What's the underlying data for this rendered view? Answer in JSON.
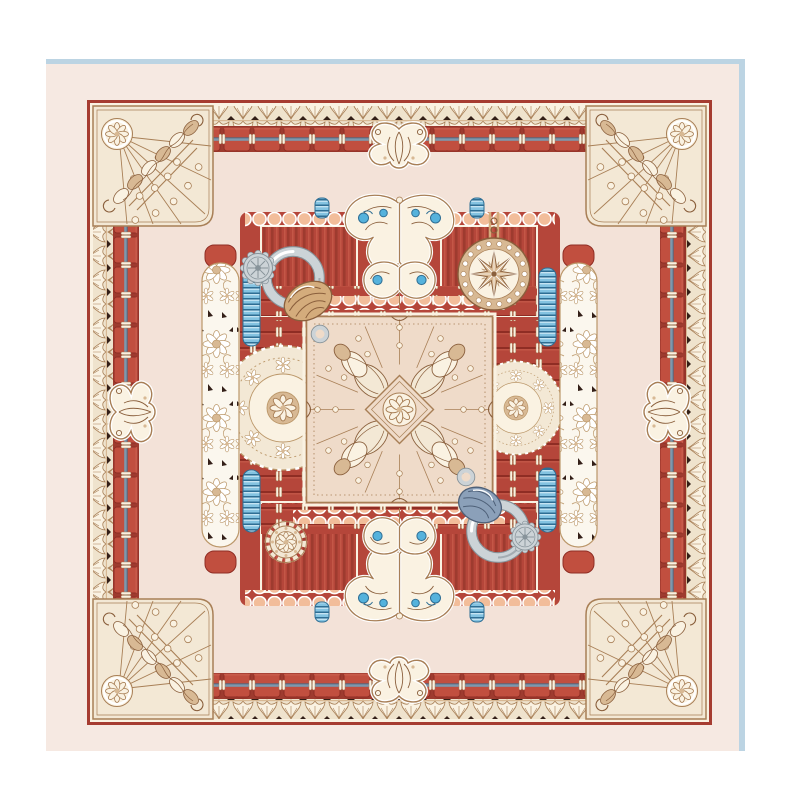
{
  "page": {
    "background": "#ffffff",
    "type": "product-photo-page"
  },
  "photo": {
    "subject": "square silk twill scarf, flat lay",
    "background": "#f6e9e2",
    "frame_line_color": "#bcd4e3",
    "frame_lines": [
      "top",
      "right"
    ]
  },
  "palette": {
    "pure": "#ffffff",
    "photoBg": "#f6e9e2",
    "frameBlue": "#bcd4e3",
    "field": "#f3e2d8",
    "redLine": "#a63c31",
    "red": "#b5463a",
    "redDark": "#8f2d24",
    "tabRed": "#c14f3f",
    "tabHi": "#c85b4a",
    "gapRed": "#9e3b2f",
    "bandBlue": "#7d98ad",
    "cream": "#f3e8d5",
    "creamHi": "#faf2e2",
    "tan": "#d8b994",
    "tanLine": "#a87f56",
    "tanDark": "#8a5f3c",
    "darkAccent": "#331f18",
    "squareBg": "#efdbc9",
    "peach": "#f2bd9a",
    "blue": "#84c3e1",
    "blueDark": "#2e6e94",
    "blueLight": "#cfeaf6",
    "accentBlue": "#55b2dc",
    "silver": "#ccd3d7",
    "silverDark": "#87939a",
    "ropeTan": "#d4ac7c",
    "ropeBlue": "#8ba0b9",
    "ropeBlueDark": "#4e6078",
    "laceBg": "#fbf7ee",
    "laceLine": "#bb9769",
    "garlandBg": "#efe3cd"
  },
  "scarf": {
    "shape": "square",
    "border": {
      "outer_pinstripe": "dark red line with cream inner pinstripe",
      "garland_band": "cream acanthus-leaf garland with dark notches",
      "stitched_band": "red saddle-stitched tabs over a steel-blue cord"
    },
    "corner_motifs": "quarter-fan medallions with eight-petal star rosettes, ray lines and dot arcs",
    "mid_edge_motifs": "acanthus scroll cartouches on all four sides",
    "center_cluster": {
      "square_panel": "engraved square with radiating lines, dot rings, diamond and eight-petal star",
      "compass_medallion": "pearl-rimmed sixteen-point compass star with chain",
      "ring_top_left": "polished steel ring with hemp rope knot and pendant loop",
      "ring_bottom_right": "polished steel ring with indigo rope knot and pendant loop",
      "buttons": "engraved silver rosette buttons",
      "coils": "turquoise ribbed cord segments",
      "lace_bands": "white daisy lace ribbons with dark picot accents",
      "doily": "ecru lace doily medallion",
      "wheel": "scalloped rosette wheel",
      "ribbons": "peach scalloped ribbons over striped red panels",
      "wings": "mirrored white acanthus wings with turquoise buds"
    }
  }
}
